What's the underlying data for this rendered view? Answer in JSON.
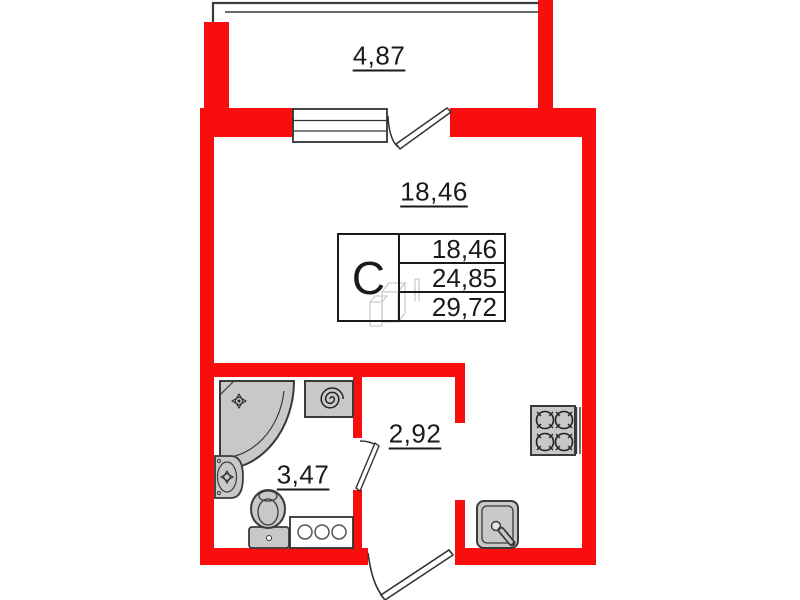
{
  "plan": {
    "title": "studio-apartment-floor-plan",
    "areas": {
      "balcony": "4,87",
      "room": "18,46",
      "bathroom": "3,47",
      "hallway": "2,92"
    },
    "stamp": {
      "unit_type": "С",
      "row1": "18,46",
      "row2": "24,85",
      "row3": "29,72"
    },
    "colors": {
      "wall_red": "#f90d0d",
      "fixture_gray": "#c8c8c8",
      "outline_dark": "#3a3a3a",
      "text_black": "#1a1a1a",
      "watermark_gray": "#cdcdcd"
    },
    "icons": [
      "balcony-parapet",
      "window-icon",
      "balcony-door-icon",
      "entrance-door-icon",
      "bathroom-door-icon",
      "shower-icon",
      "washing-machine-icon",
      "bathroom-sink-icon",
      "toilet-icon",
      "bathroom-cabinet-icon",
      "stove-icon",
      "kitchen-sink-icon",
      "watermark-3d-box"
    ]
  }
}
